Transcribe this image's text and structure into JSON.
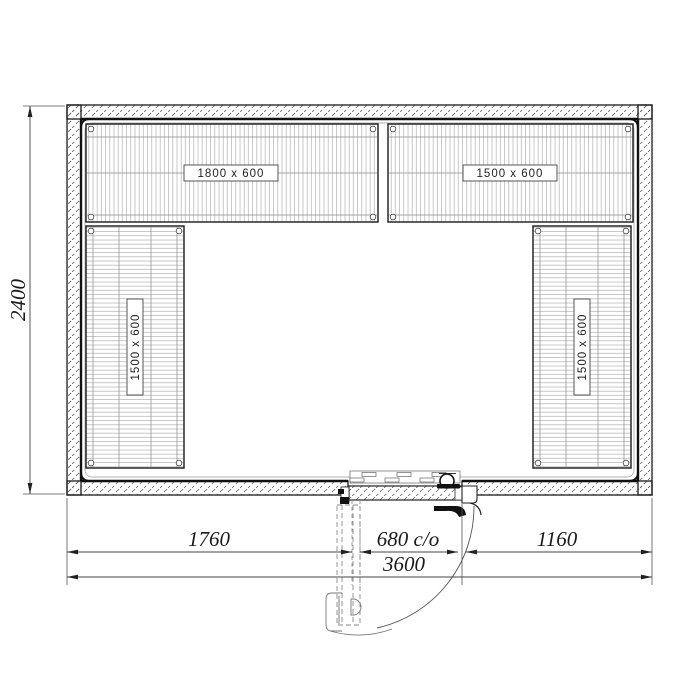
{
  "shelf_labels": {
    "top_left": "1800 x 600",
    "top_right": "1500 x 600",
    "left": "1500 x 600",
    "right": "1500 x 600"
  },
  "dimensions": {
    "room_height": "2400",
    "left_of_door": "1760",
    "door_opening": "680 c/o",
    "right_of_door": "1160",
    "total_width": "3600"
  },
  "colors": {
    "line": "#1a1a1a",
    "dim_line": "#555555",
    "hatch": "#555555",
    "wire": "#a5a5a5",
    "background": "#ffffff"
  }
}
